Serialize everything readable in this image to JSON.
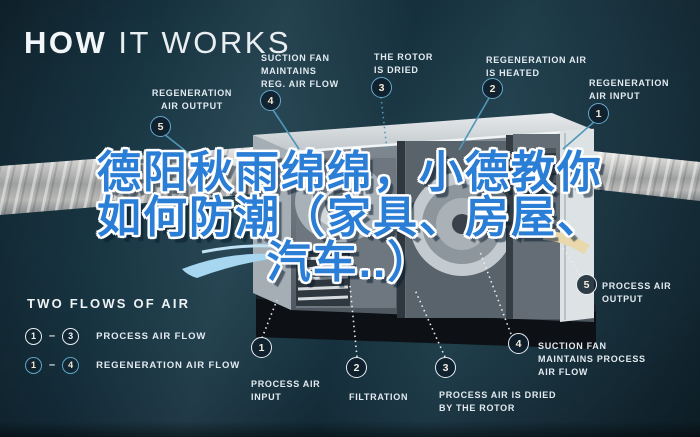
{
  "title": {
    "word_bold": "HOW",
    "word_light": " IT WORKS"
  },
  "watermark": {
    "lines": [
      "德阳秋雨绵绵，小德教你",
      "如何防潮（家具、房屋、",
      "汽车..）"
    ],
    "text_color": "#2b7ed6",
    "outline_color": "#ffffff"
  },
  "callouts": {
    "regen_output": {
      "num": "5",
      "text": "REGENERATION\nAIR OUTPUT"
    },
    "regen_fan": {
      "num": "4",
      "text": "SUCTION FAN\nMAINTAINS\nREG. AIR FLOW"
    },
    "rotor_dried": {
      "num": "3",
      "text": "THE ROTOR\nIS DRIED"
    },
    "regen_heated": {
      "num": "2",
      "text": "REGENERATION AIR\nIS HEATED"
    },
    "regen_input": {
      "num": "1",
      "text": "REGENERATION\nAIR INPUT"
    },
    "process_input": {
      "num": "1",
      "text": "PROCESS AIR\nINPUT"
    },
    "filtration": {
      "num": "2",
      "text": "FILTRATION"
    },
    "process_dried": {
      "num": "3",
      "text": "PROCESS AIR IS DRIED\nBY THE ROTOR"
    },
    "process_fan": {
      "num": "4",
      "text": "SUCTION FAN\nMAINTAINS PROCESS\nAIR FLOW"
    },
    "process_output": {
      "num": "5",
      "text": "PROCESS AIR\nOUTPUT"
    }
  },
  "legend": {
    "title": "TWO FLOWS OF AIR",
    "rows": [
      {
        "from": "1",
        "dash": "–",
        "to": "3",
        "label": "PROCESS AIR FLOW",
        "style": "white"
      },
      {
        "from": "1",
        "dash": "–",
        "to": "4",
        "label": "REGENERATION AIR FLOW",
        "style": "blue"
      }
    ]
  },
  "colors": {
    "background": "#16313e",
    "accent_blue": "#66a9cb",
    "badge_white": "#e9eef2",
    "number_cream": "#f2ead4",
    "label_text": "#e3ebf0",
    "duct_metal": "#c9cbca",
    "machine_light": "#d7dcdf",
    "machine_dark": "#4e575f"
  }
}
